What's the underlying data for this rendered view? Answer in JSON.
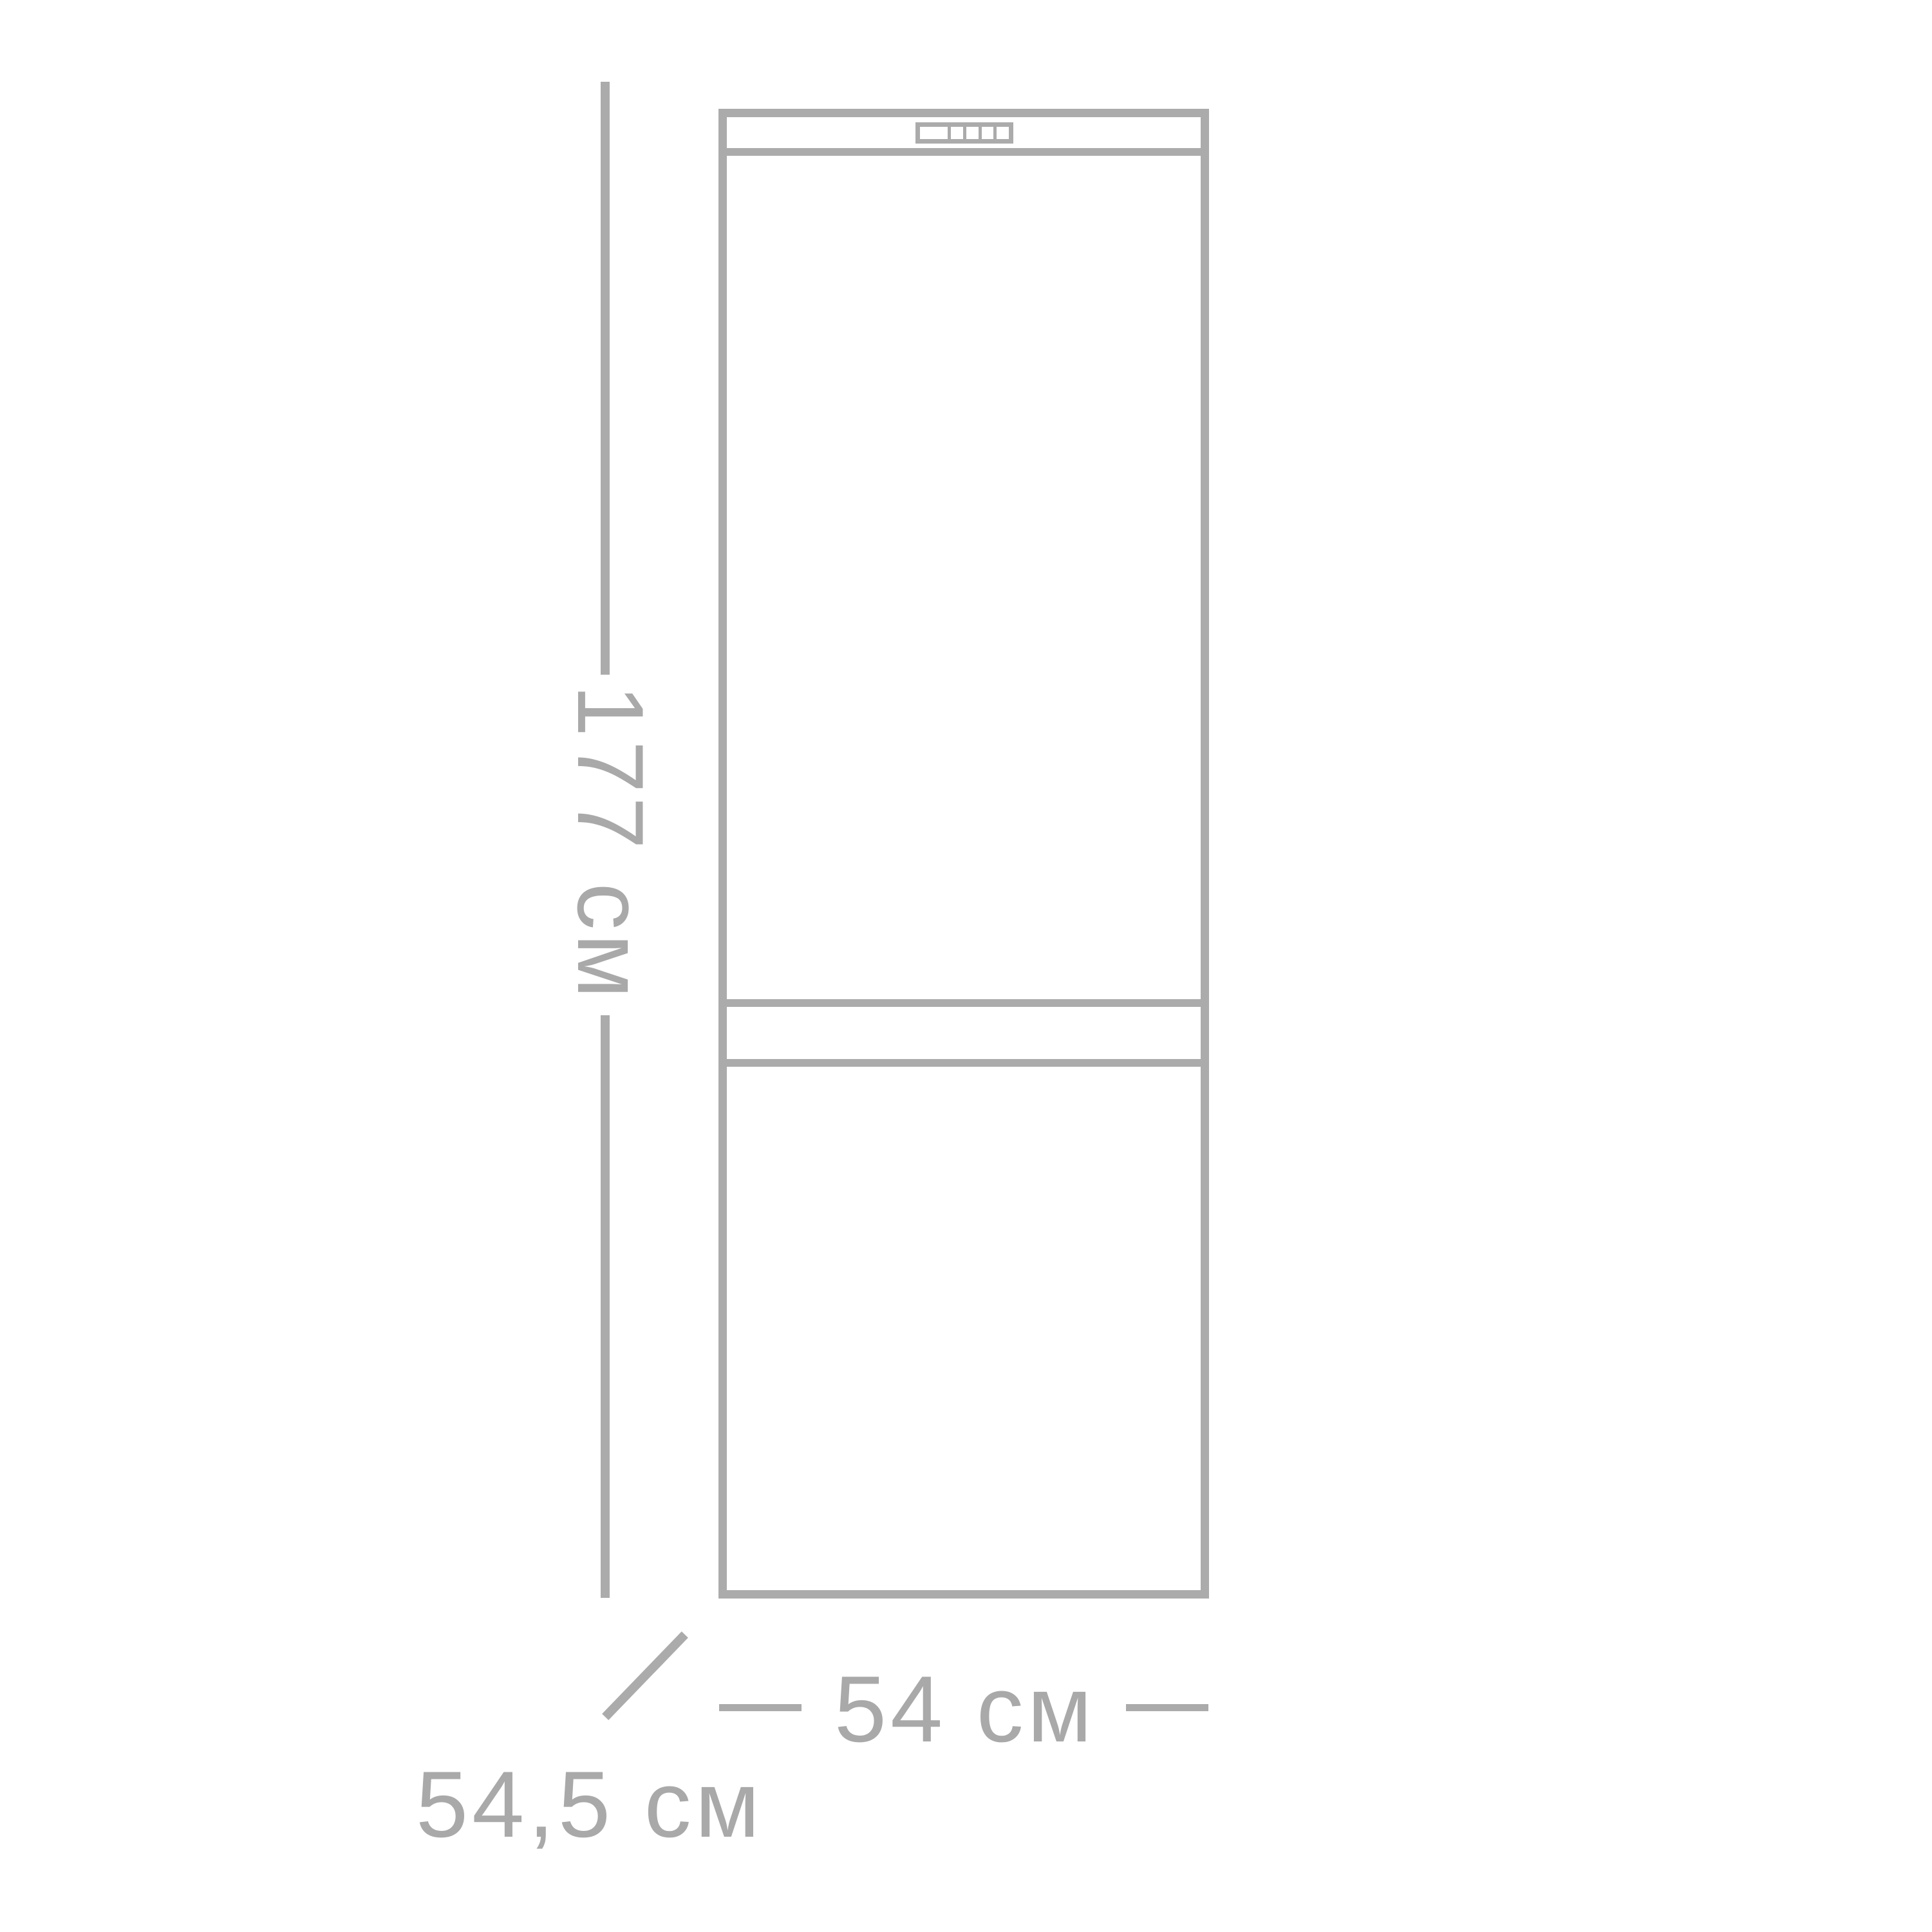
{
  "diagram": {
    "subject": "refrigerator-dimensions-outline",
    "labels": {
      "height": "177 см",
      "width": "54 см",
      "depth": "54,5 см"
    },
    "colors": {
      "line": "#ababab",
      "text": "#a9a9a9",
      "background": "#ffffff"
    },
    "icons": [
      "control-panel-icon"
    ]
  }
}
